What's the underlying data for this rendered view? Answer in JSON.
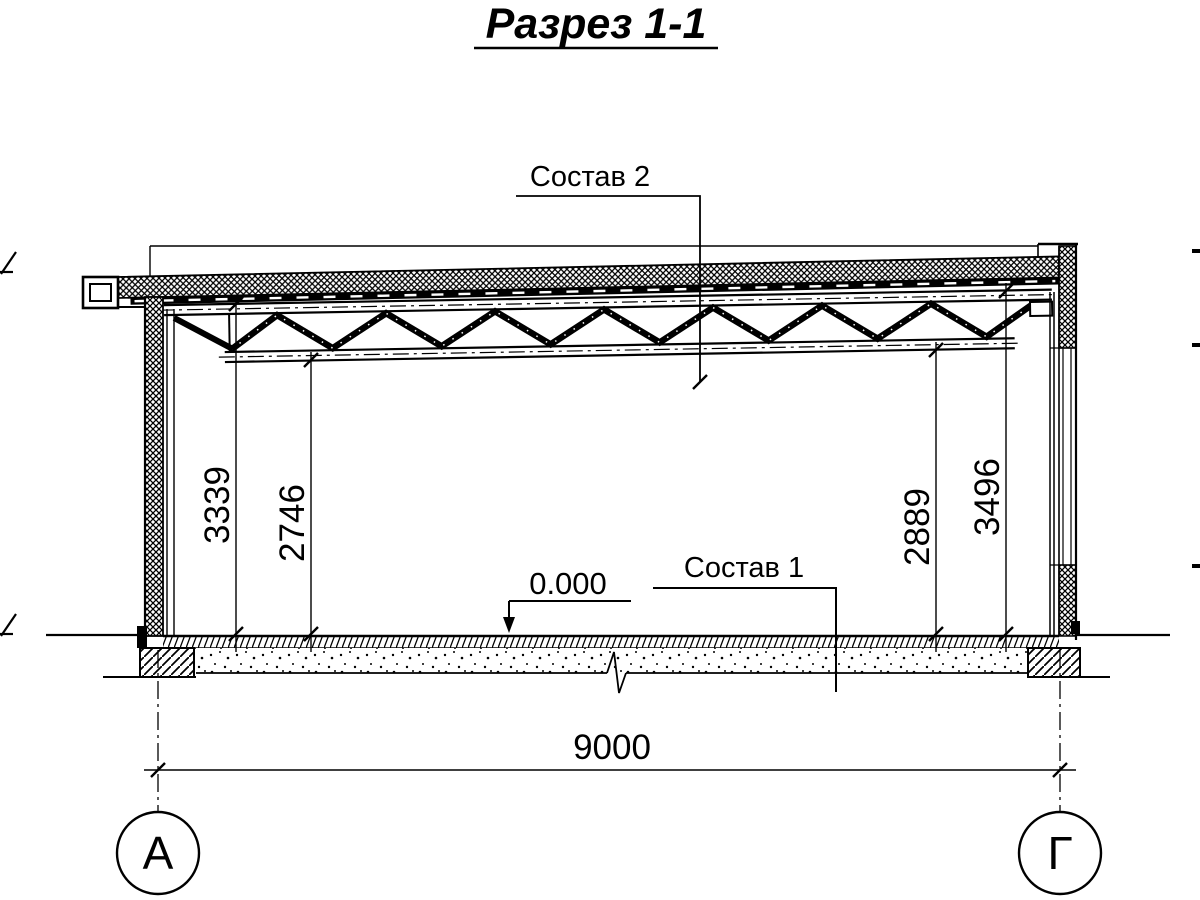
{
  "title": "Разрез 1-1",
  "callouts": {
    "roof_layers": "Состав 2",
    "floor_layers": "Состав 1"
  },
  "levels": {
    "floor": "0.000"
  },
  "dimensions": {
    "heights_left": [
      "3339",
      "2746"
    ],
    "heights_right": [
      "2889",
      "3496"
    ],
    "span_bottom": "9000"
  },
  "axes": {
    "left": "А",
    "right": "Г"
  },
  "colors": {
    "ink": "#000000",
    "paper": "#ffffff"
  }
}
